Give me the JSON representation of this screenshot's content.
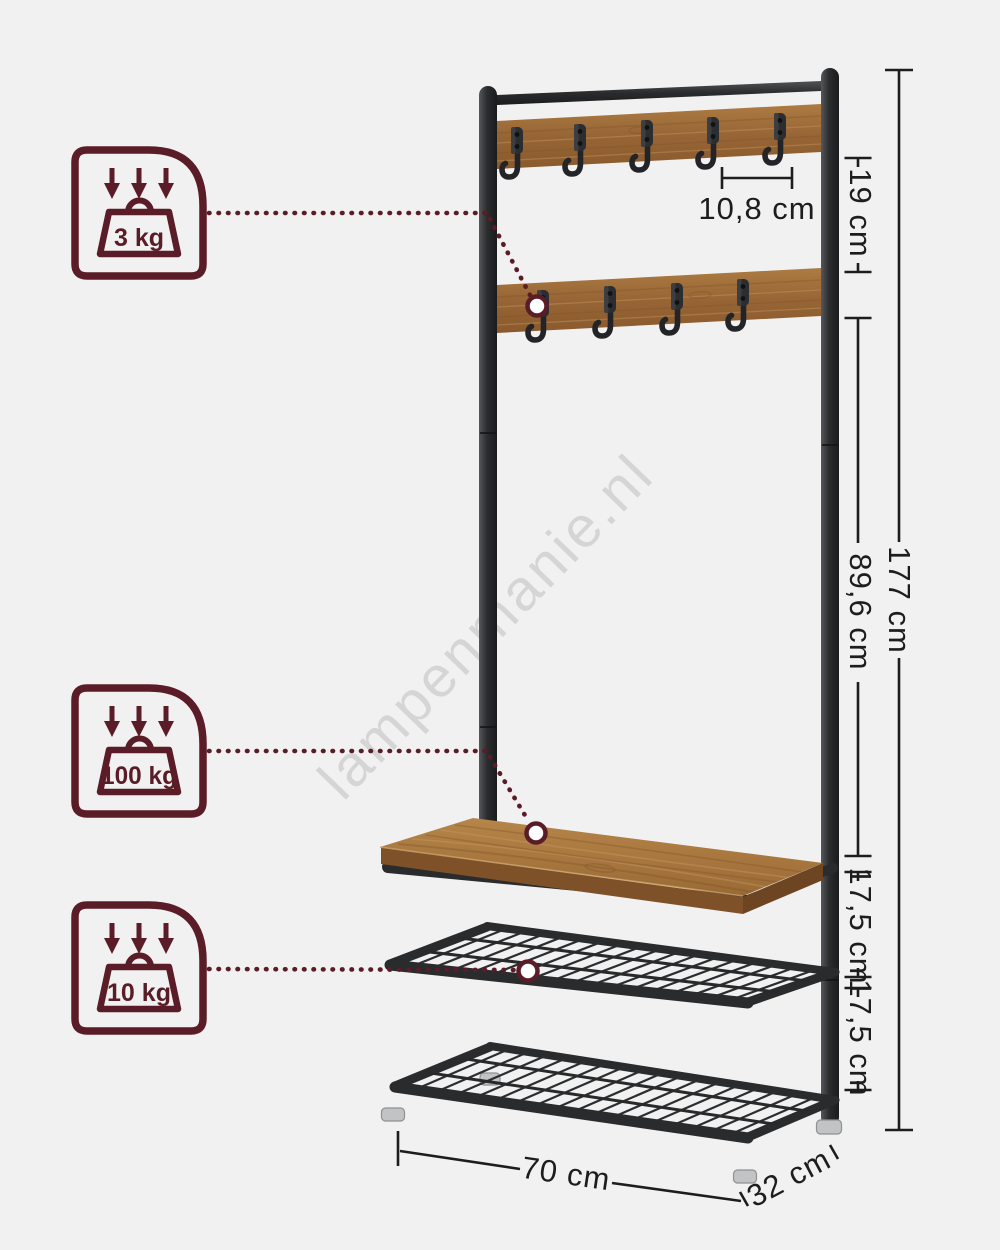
{
  "watermark": "lampenmanie.nl",
  "badges": [
    {
      "id": "hook-capacity",
      "label": "3 kg",
      "icon": "weight-icon",
      "arrows_icon": "down-arrows-icon"
    },
    {
      "id": "bench-capacity",
      "label": "100 kg",
      "icon": "weight-icon",
      "arrows_icon": "down-arrows-icon"
    },
    {
      "id": "shelf-capacity",
      "label": "10 kg",
      "icon": "weight-icon",
      "arrows_icon": "down-arrows-icon"
    }
  ],
  "dimensions": {
    "hook_spacing": "10,8 cm",
    "board_gap": "19 cm",
    "total_height": "177 cm",
    "board_to_bench": "89,6 cm",
    "bench_to_shelf": "17,5 cm",
    "shelf_to_shelf": "17,5 cm",
    "width": "70 cm",
    "depth": "32 cm"
  },
  "colors": {
    "background": "#f1f1f1",
    "accent_maroon": "#5a1c27",
    "metal_dark": "#2b2c2e",
    "wood_brown": "#9c6a36",
    "dimension_ink": "#1d1d1d",
    "watermark_gray": "#c7c7c7"
  }
}
